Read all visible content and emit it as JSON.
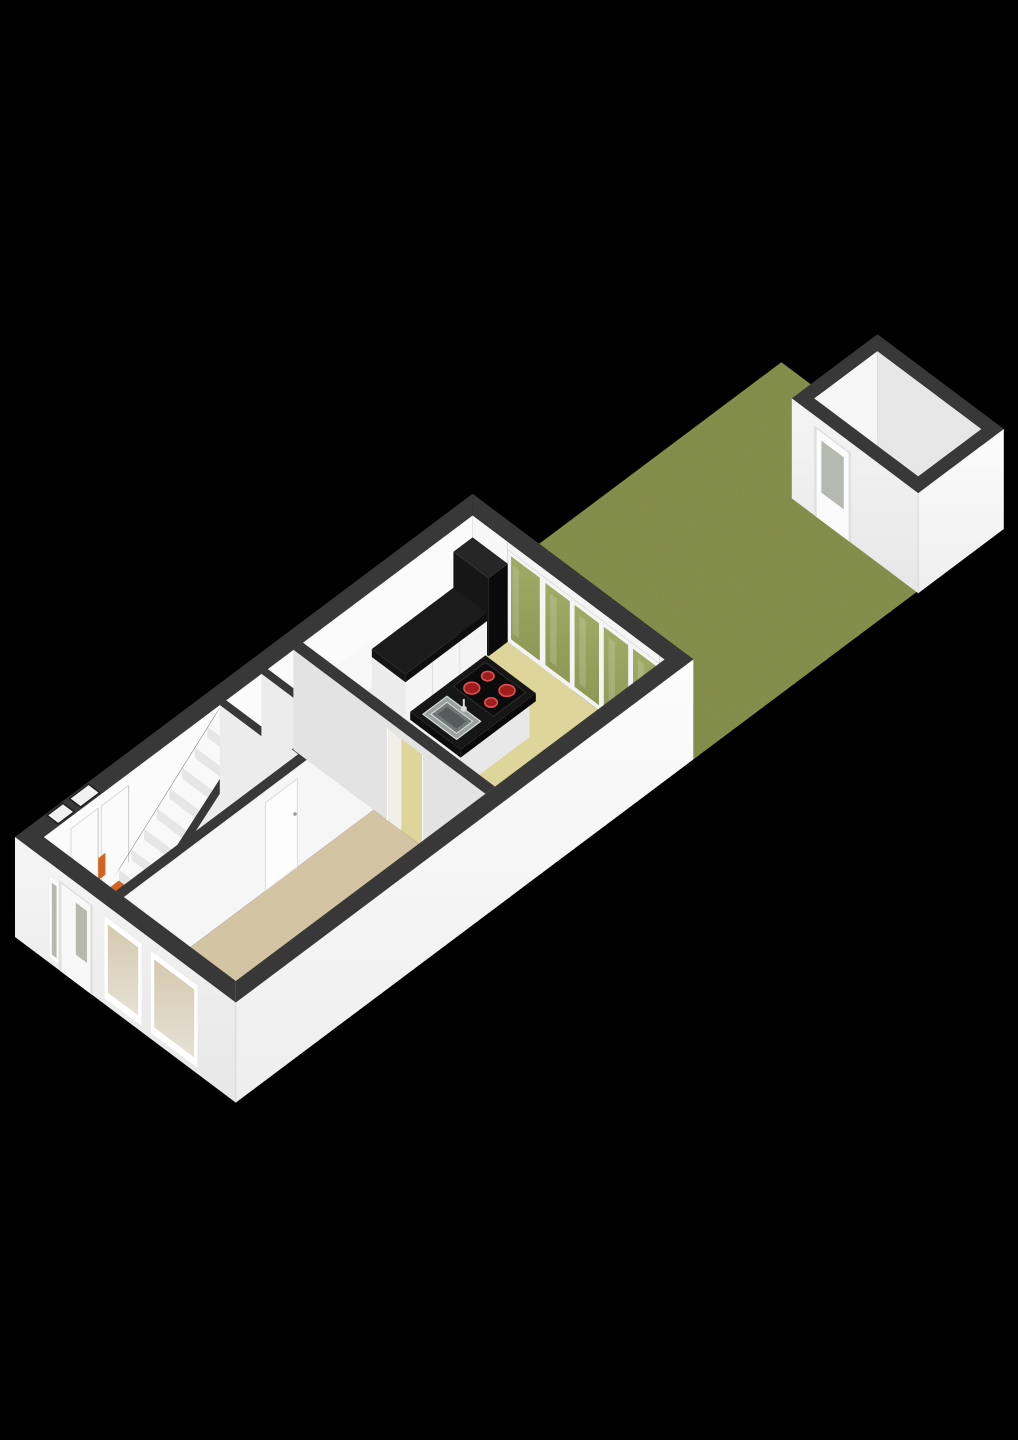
{
  "page": {
    "background": "#000000",
    "label": "3D plattegrond begane grond met tuin en berging"
  },
  "colors": {
    "bg": "#000000",
    "cap": "#383838",
    "capSoft": "#454545",
    "wallInterior": "#fbfbfb",
    "wallInteriorShade": "#ececec",
    "wallInteriorDim": "#e0e0e0",
    "facade": "#f5f5f5",
    "facadeShade": "#e7e7e7",
    "facadeSE": "#fcfcfc",
    "facadeSEShade": "#eeeeee",
    "floorHall": "#f1f1ee",
    "floorLiving": "#d3c4a4",
    "floorKitchen": "#ded59b",
    "floorShed": "#d7caa6",
    "grass": "#87914e",
    "grassDark": "#76813f",
    "black": "#161616",
    "blackDeep": "#0a0a0a",
    "blackSoft": "#262626",
    "steel": "#9aa19f",
    "steelDark": "#717878",
    "steelLight": "#d9dddc",
    "burner": "#a01d1d",
    "burnerRing": "#e05050",
    "orange": "#d2641f",
    "glassGarden": "#8d9854",
    "glassGardenLight": "#a0ab66",
    "glassDoorPane": "#b5b9af",
    "glassFront": "#d5c9ae",
    "glassFrontLight": "#e6e1d6",
    "frame": "#ffffff",
    "frameSoft": "#f0f0f0",
    "line": "#d6d6d6"
  },
  "scene": {
    "projection": "axonometric",
    "areas": [
      {
        "id": "hall",
        "label": "hal"
      },
      {
        "id": "toilet",
        "label": "toilet"
      },
      {
        "id": "storage",
        "label": "kast"
      },
      {
        "id": "living-room",
        "label": "woonkamer"
      },
      {
        "id": "kitchen",
        "label": "keuken"
      },
      {
        "id": "garden",
        "label": "tuin"
      },
      {
        "id": "shed",
        "label": "berging"
      }
    ],
    "objects": [
      {
        "id": "stairs",
        "label": "trap",
        "steps": 8
      },
      {
        "id": "stair-mat",
        "label": "mat",
        "color_key": "orange"
      },
      {
        "id": "kitchen-island",
        "label": "kookeiland",
        "features": [
          "spoelbak",
          "kookplaat"
        ]
      },
      {
        "id": "cooktop",
        "label": "kookplaat",
        "burners": 4
      },
      {
        "id": "kitchen-counter",
        "label": "aanrecht"
      },
      {
        "id": "tall-cabinet",
        "label": "kastenwand"
      },
      {
        "id": "front-door",
        "label": "voordeur",
        "glazed": true
      },
      {
        "id": "front-windows",
        "label": "raam",
        "count": 2
      },
      {
        "id": "back-door",
        "label": "tuindeur",
        "glazed": true
      },
      {
        "id": "sliding-door",
        "label": "schuifpui",
        "panels": 4
      },
      {
        "id": "shed-door",
        "label": "deur berging",
        "glazed": true
      }
    ]
  }
}
